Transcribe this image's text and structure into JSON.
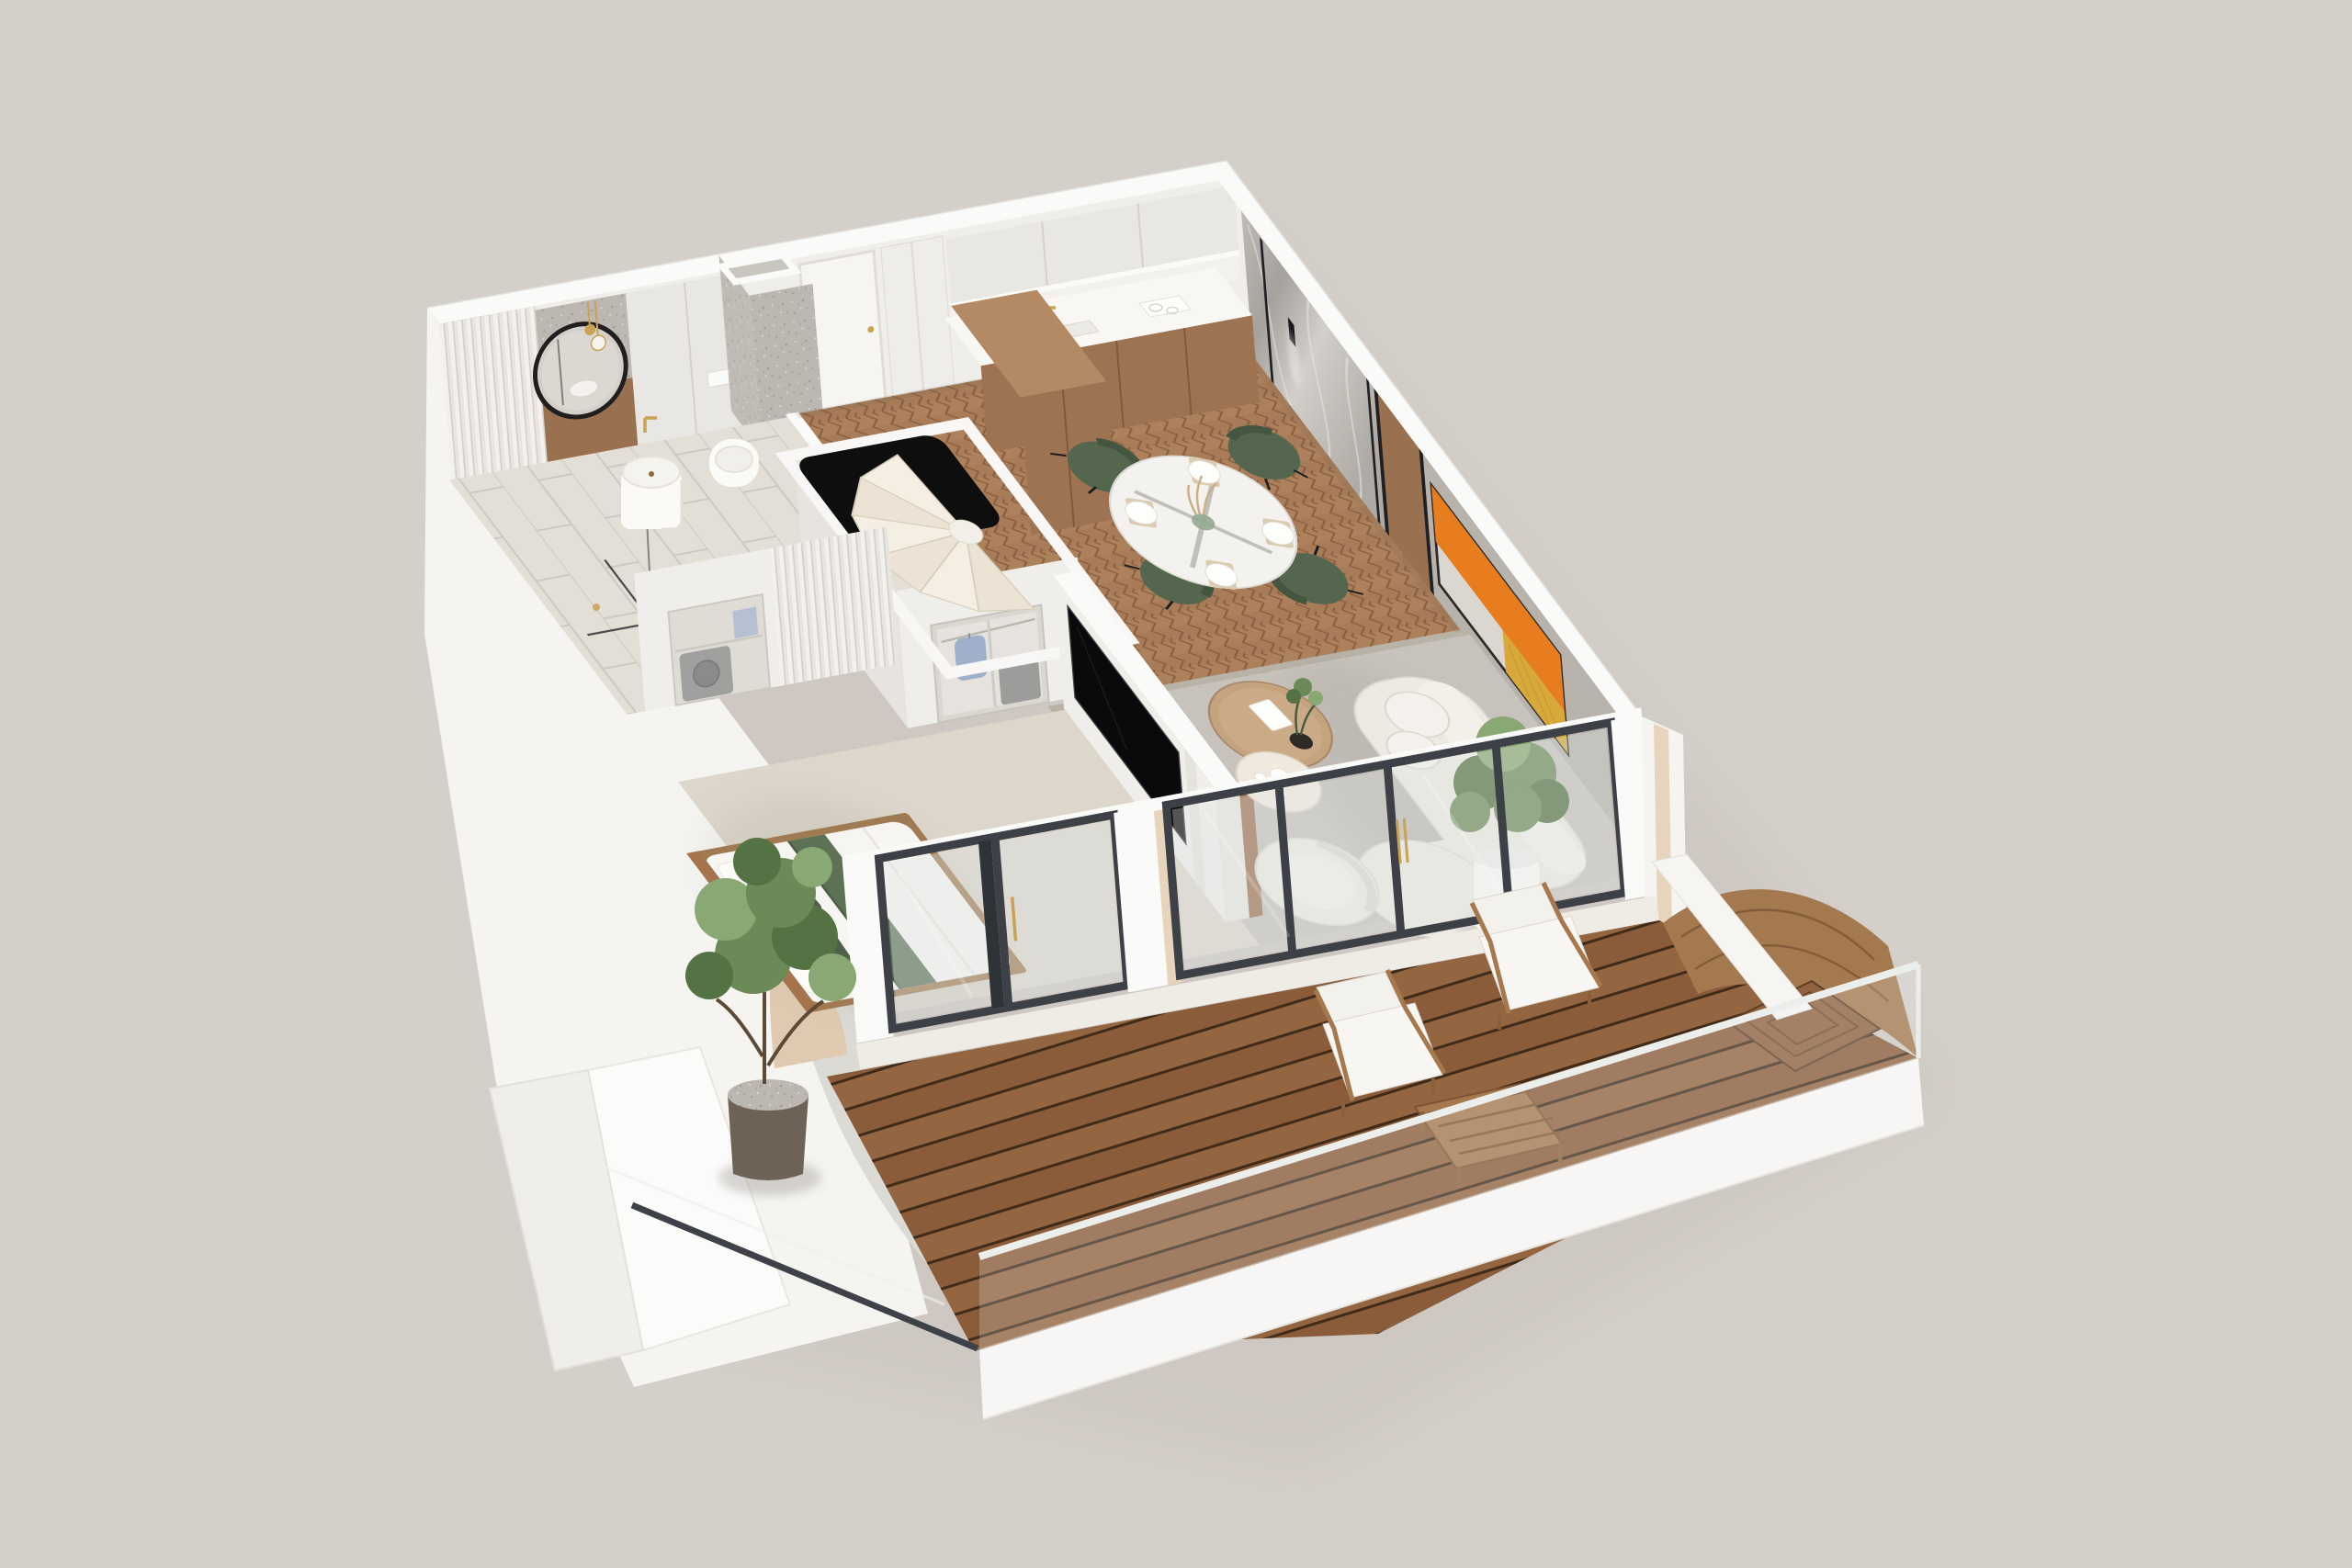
{
  "scene": {
    "type": "3d-floorplan-render",
    "title": "Axonometric cutaway render of a one-bedroom apartment with balcony",
    "view": "top-down axonometric, plan rotated ~40 degrees",
    "visible_text": ""
  },
  "palette": {
    "bg": "#d5cfca",
    "wallTop": "#fafaf8",
    "wallFace": "#f0eeea",
    "wallFaceDim": "#e7e4df",
    "cabinetLight": "#e9e7e3",
    "counterWhite": "#f8f7f4",
    "woodCab": "#9e7352",
    "woodLight": "#b38a64",
    "woodPanel": "#9a7150",
    "parquetBase": "#a87c58",
    "parquetDark": "#8a5f41",
    "parquetLight": "#bb9068",
    "concreteFloor": "#c7c3bc",
    "concreteWall": "#b7b3ac",
    "carpet": "#dcd6cb",
    "tile": "#e3dfd7",
    "grout": "#cbc7bf",
    "marbleA": "#c6c2bd",
    "marbleB": "#a5a19c",
    "artOrange": "#e87d1f",
    "artGold": "#d7a83a",
    "artPale": "#dbd7d0",
    "frameDark": "#3d4147",
    "glassTint": "#dfe5e4",
    "gold": "#c9a254",
    "greenChair": "#54664e",
    "greenBed": "#5d7254",
    "greenBedDark": "#4f6148",
    "sofa": "#edeae3",
    "sofaShade": "#d9d5cc",
    "deckWoodA": "#8a5c3a",
    "deckWoodB": "#936541",
    "deckGap": "#402b18",
    "deckLight": "#a5794f",
    "teak": "#a6784e",
    "leaf": "#6c8a58",
    "leafDark": "#557244",
    "leafLight": "#8aa873",
    "slab": "#f5f4f1",
    "walkway": "#dcdad5",
    "tan": "#dfcab1",
    "beigeStrip": "#e6d4bd",
    "voidBlack": "#0e0e0e",
    "cream": "#f3ecdf",
    "creamDim": "#e9dfcf",
    "blueShirt": "#9fb0cb",
    "washerGray": "#9c9c9a",
    "threshold": "#efece6",
    "railLight": "#eceeec"
  },
  "rooms": [
    {
      "id": "bathroom",
      "features": [
        "round-black-mirror",
        "gold-pendant-lights",
        "freestanding-square-sink",
        "gold-wall-faucet",
        "wall-hung-toilet",
        "wood-accent-wainscot",
        "fluted-wall-panel",
        "walk-in-shower-glass",
        "stone-tile-floor",
        "tall-storage-cabinets"
      ]
    },
    {
      "id": "entry-hall",
      "features": [
        "white-entry-door",
        "gold-door-handle",
        "stone-utility-column-with-duct",
        "white-wardrobe"
      ]
    },
    {
      "id": "kitchen",
      "features": [
        "white-upper-cabinets",
        "under-cabinet-light",
        "white-countertop",
        "gold-faucet",
        "sink",
        "induction-hob",
        "oak-base-cabinets",
        "tall-oak-cabinet-block",
        "glass-carafes"
      ]
    },
    {
      "id": "dining-area",
      "features": [
        "round-white-table-black-base",
        "green-velvet-chairs-x4",
        "place-settings-x4",
        "green-glass-vase-with-dried-stems",
        "herringbone-parquet-floor"
      ]
    },
    {
      "id": "living-room",
      "features": [
        "curved-boucle-sofa",
        "round-bolster-cushions",
        "boucle-armchair",
        "round-oak-coffee-table",
        "cream-pedestal-side-table",
        "tea-set",
        "abstract-artwork-orange-white-gold",
        "marble-feature-wall-with-led-strips",
        "black-wall-sconce",
        "wood-wall-panels",
        "potted-tree-white-pot",
        "microcement-floor"
      ]
    },
    {
      "id": "bedroom",
      "features": [
        "double-bed-white-linen",
        "green-velvet-runner-and-pillows",
        "wood-bed-frame",
        "wall-mounted-tv-on-partition",
        "open-closet-hanging-shirt",
        "storage-box",
        "washer-niche",
        "fluted-wardrobe-front",
        "carpet-floor"
      ]
    },
    {
      "id": "staircase",
      "features": [
        "winder-spiral-stairs-cream",
        "black-stair-void",
        "white-parapet"
      ]
    },
    {
      "id": "balcony",
      "features": [
        "hardwood-deck-boards",
        "glass-balustrade-light-rail",
        "teak-lounge-chairs-x2-white-cushions",
        "teak-slatted-coffee-table",
        "potted-tree-speckled-pot",
        "curved-deck-wave",
        "square-slat-platform",
        "white-diagonal-bench"
      ]
    },
    {
      "id": "facade",
      "features": [
        "dark-framed-sliding-glass-doors",
        "gold-handles",
        "white-piers",
        "beige-accent-band",
        "white-lower-terrace-slabs",
        "gray-curved-walkway",
        "tan-curved-wall"
      ]
    }
  ]
}
